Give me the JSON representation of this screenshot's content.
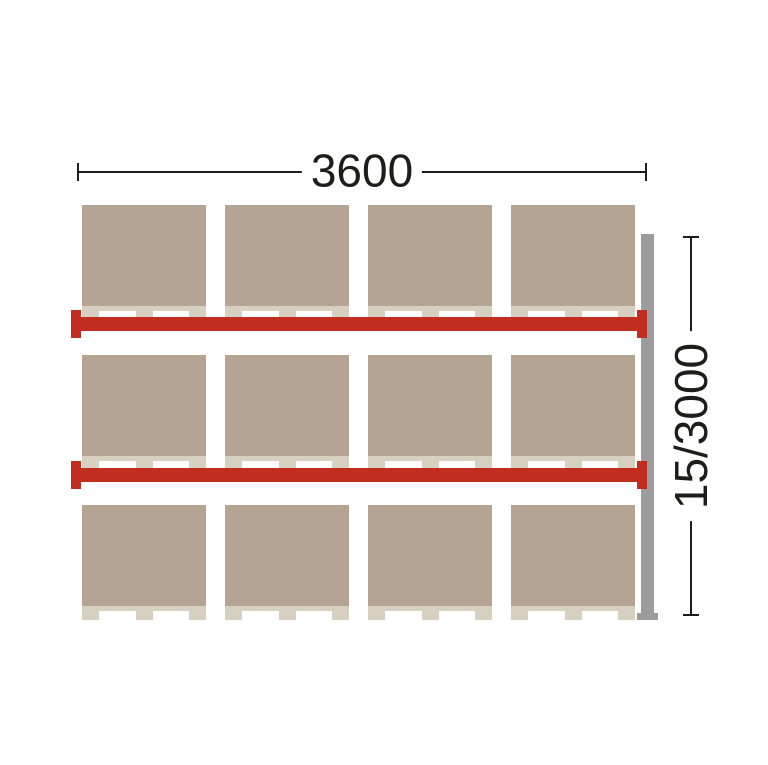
{
  "dimensions": {
    "width": {
      "label": "3600"
    },
    "height": {
      "label": "15/3000"
    }
  },
  "rack": {
    "pallet_columns": 4,
    "pallet_rows": 3,
    "beam_levels": 2,
    "pallet_count": 12
  },
  "colors": {
    "load": "#b4a491",
    "wood": "#d7cfc0",
    "beam": "#c12d1f",
    "upright": "#9c9c9c",
    "dim": "#1d1d1b",
    "bg": "#ffffff"
  }
}
